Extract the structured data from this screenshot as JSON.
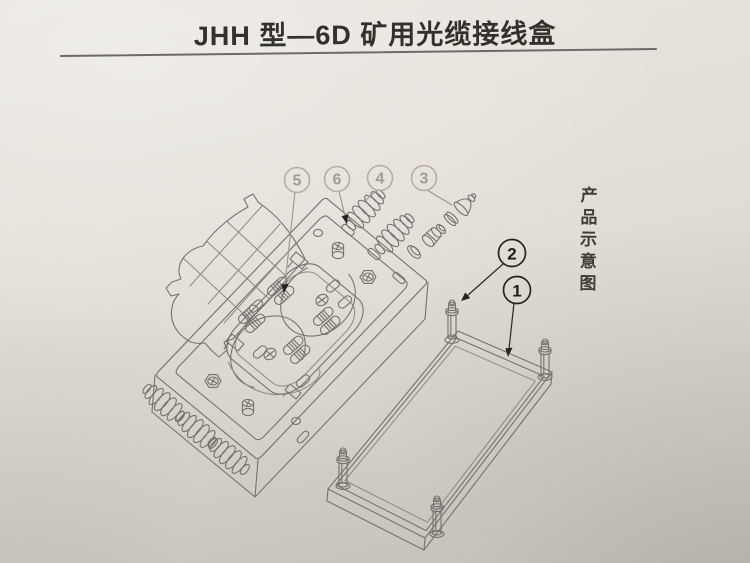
{
  "header": {
    "title": "JHH 型—6D 矿用光缆接线盒"
  },
  "side_caption": {
    "text": "产品示意图"
  },
  "diagram": {
    "callouts": [
      {
        "label": "5",
        "style": "light"
      },
      {
        "label": "6",
        "style": "light"
      },
      {
        "label": "4",
        "style": "light"
      },
      {
        "label": "3",
        "style": "light"
      },
      {
        "label": "2",
        "style": "dark"
      },
      {
        "label": "1",
        "style": "dark"
      }
    ]
  },
  "colors": {
    "paper": "#e2ded6",
    "line": "#75726d",
    "ink": "#33312d",
    "callout_light": "#a19b91",
    "callout_dark": "#1e1c19"
  }
}
